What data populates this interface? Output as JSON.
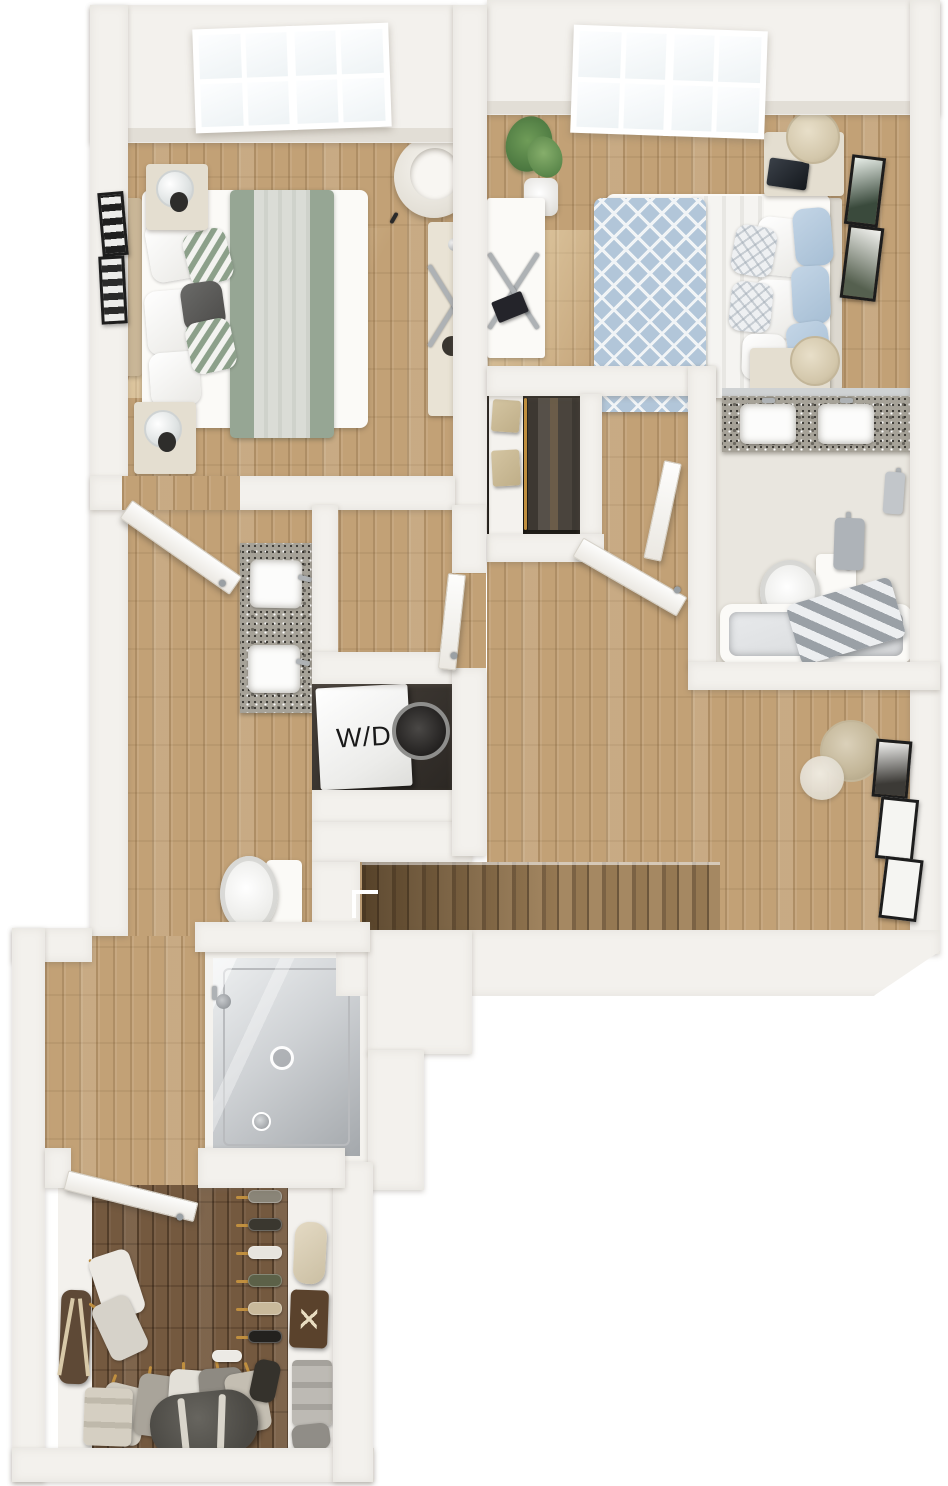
{
  "meta": {
    "kind": "3D floor plan rendering",
    "view": "top-down dollhouse view of an upper-level apartment floor",
    "background_color": "#ffffff"
  },
  "labels": {
    "washer_dryer": "W/D"
  },
  "palette": {
    "wall": "#f3f1ed",
    "wall_face": "#e2ded6",
    "wood_light": "#c2a176",
    "wood_dark": "#74593f",
    "stair_wood": "#8a6f4c",
    "mattress_white": "#fbfaf7",
    "blanket_sage": "#96a694",
    "duvet_blue": "#b2c6d9",
    "pillow_blue": "#b6cbe0",
    "furniture_cream": "#e4ded0",
    "granite": "#a6a298",
    "fixture_white": "#fcfcfb",
    "shower_glass": "#ccd0d3",
    "chrome": "#aeb2b5",
    "closet_interior": "#27231f",
    "bag_brown": "#5e4936",
    "duffel_gray": "#56544f",
    "hanger_gold": "#c08f3f"
  },
  "rooms": [
    {
      "name": "bedroom-1",
      "position": "top-left",
      "items": [
        "window",
        "bed with sage striped blanket",
        "white and patterned pillows",
        "two nightstands with glass lamps",
        "framed wall art",
        "barrel armchair",
        "console desk with chrome X legs"
      ]
    },
    {
      "name": "bedroom-2",
      "position": "top-right",
      "items": [
        "window",
        "bed with blue diamond duvet",
        "blue and white pillows",
        "nightstand with drum lamp and tablet",
        "two framed artworks",
        "potted plant",
        "desk with chrome X legs",
        "second nightstand with drum lamp"
      ]
    },
    {
      "name": "reach-in-closet",
      "position": "center",
      "items": [
        "white shelf with two storage boxes",
        "hanging clothes",
        "door to hallway"
      ]
    },
    {
      "name": "bathroom-2",
      "position": "right",
      "items": [
        "granite vanity with two sinks",
        "toilet",
        "towel bar with towel",
        "bathtub",
        "striped towel"
      ]
    },
    {
      "name": "hallway-landing",
      "position": "center-right",
      "items": [
        "wood floor",
        "staircase going down",
        "floor lamp",
        "three picture frames"
      ]
    },
    {
      "name": "primary-bathroom",
      "position": "center-left",
      "items": [
        "entry door",
        "granite vanity with two sinks",
        "toilet",
        "laundry niche"
      ]
    },
    {
      "name": "laundry-closet",
      "position": "center-left",
      "items": [
        "stacked washer dryer labeled W/D"
      ]
    },
    {
      "name": "walk-in-shower",
      "position": "bottom-left",
      "items": [
        "glass enclosure",
        "shower head",
        "drain",
        "valve control"
      ]
    },
    {
      "name": "walk-in-closet",
      "position": "bottom",
      "items": [
        "dark wood floor",
        "entry door",
        "shoe shelves",
        "handbags",
        "monogram duffel",
        "gray duffel bag",
        "hanging clothes",
        "folded stacks"
      ]
    }
  ]
}
